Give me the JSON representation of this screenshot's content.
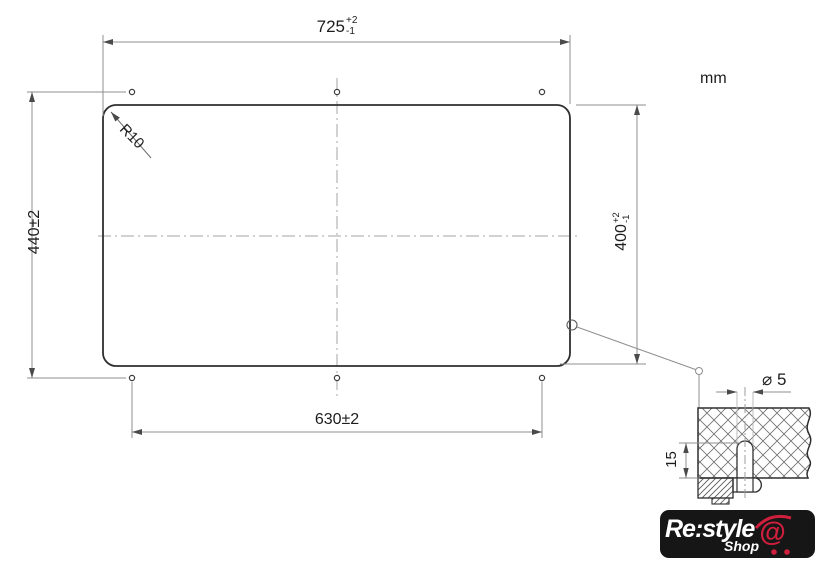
{
  "drawing": {
    "unit": "mm",
    "dim_width": {
      "value": "725",
      "tol_plus": "+2",
      "tol_minus": "-1"
    },
    "dim_height_right": {
      "value": "400",
      "tol_plus": "+2",
      "tol_minus": "-1"
    },
    "dim_height_left": "440±2",
    "dim_bottom_width": "630±2",
    "corner_radius": "R10",
    "hole_diameter": "⌀ 5",
    "hole_depth": "15"
  },
  "logo": {
    "brand": "Re:style",
    "shop": "Shop",
    "at": "@"
  },
  "colors": {
    "outline": "#2f2f2f",
    "dimension_lines": "#8f8f8f",
    "logo_background": "#161616",
    "logo_accent_red": "#cf1f3d"
  }
}
